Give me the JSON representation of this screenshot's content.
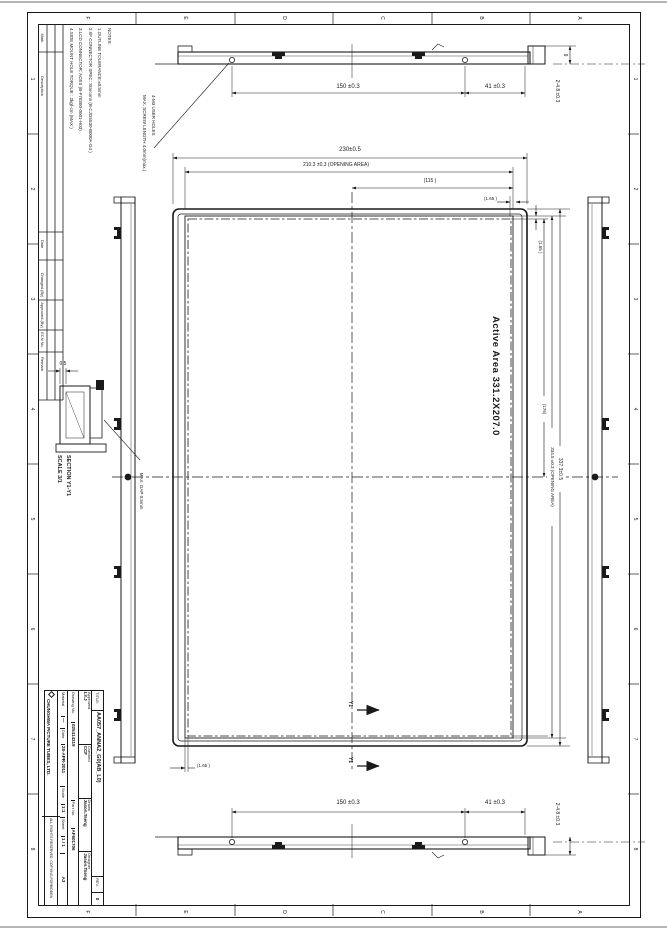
{
  "frame": {
    "zones_top": [
      "F",
      "E",
      "D",
      "C",
      "B",
      "A"
    ],
    "zones_bottom": [
      "F",
      "E",
      "D",
      "C",
      "B",
      "A"
    ],
    "zones_left": [
      "1",
      "2",
      "3",
      "4",
      "5",
      "6",
      "7",
      "8"
    ],
    "zones_right": [
      "1",
      "2",
      "3",
      "4",
      "5",
      "6",
      "7",
      "8"
    ]
  },
  "revision_table": {
    "headers": [
      "Mark",
      "Description",
      "Date",
      "Changed.(By)",
      "Approved.(By)",
      "ECN No.",
      "Remark"
    ]
  },
  "notes": {
    "lines": [
      "NOTES:",
      "1.OUTLINE TOLERANCE:±0.5mm",
      "2.I/F CONNECTOR SPEC: Starconn (B-CJG5530-B000A-G4 )",
      "3.LCD CONNECTOR: ACES (B-F70300-0001-H03)",
      "4.SIDE MOUNT HOLE TORQUE : 2kgf-cm (MAX.)"
    ]
  },
  "top_view": {
    "dim_150": "150 ±0.3",
    "dim_41": "41 ±0.3",
    "dim_48": "2-4.8 ±0.3",
    "dim_9": "9",
    "user_holes_note_line1": "4-M3 USER HOLES",
    "user_holes_note_line2": "MAX. SCREW LENGTH 4.0mm(max.)"
  },
  "bottom_view": {
    "dim_150": "150 ±0.3",
    "dim_41": "41 ±0.3",
    "dim_48": "2-4.8 ±0.3"
  },
  "main_view": {
    "dim_outer_width": "230±0.5",
    "dim_opening_width": "210.3 ±0.3 (OPENING AREA)",
    "dim_115": "(115 )",
    "dim_165_top": "(1.65 )",
    "dim_165_bottom": "(1.65 )",
    "dim_165_right": "(1.65 )",
    "dim_176": "(176)",
    "dim_opening_height": "334.5 ±0.3 (OPENING AREA)",
    "dim_outer_height": "337.3±0.5",
    "active_area_label": "Active Area 331.2X207.0",
    "section_cut_label": "Y1"
  },
  "section_detail": {
    "title": "SECTION Y1-Y1",
    "scale": "SCALE 3/1",
    "gap_note": "MAX. GAP 0.5mm",
    "dim_05": "0.5"
  },
  "title_block": {
    "title_label": "TITLE:",
    "title": "AA057_ANNA2_G0(AB_L0)",
    "rev_label": "REV.",
    "rev": "0",
    "approved_label": "Approved",
    "approved": "LY.J",
    "checked_label": "Checked",
    "checked": "CCF",
    "drawn_label": "Drawn",
    "drawn": "Jason.Tseng",
    "designer_label": "Designer",
    "designer": "Jason.Tseng",
    "drawing_no_label": "Drawing No.",
    "drawing_no": "025414319",
    "part_no_label": "Part No.",
    "part_no": "AF601706",
    "material_label": "Material",
    "material": "—",
    "date_label": "Date",
    "date": "28-APR-2011",
    "scale_label": "Scale",
    "scale": "1:1",
    "sheet_label": "Sheet",
    "sheet": "1 / 1",
    "size": "A3",
    "company": "CHUNGHWA PICTURE TUBES, LTD.",
    "copyright": "ALL RIGHTS RESERVED, COPYING FORBIDDEN"
  }
}
